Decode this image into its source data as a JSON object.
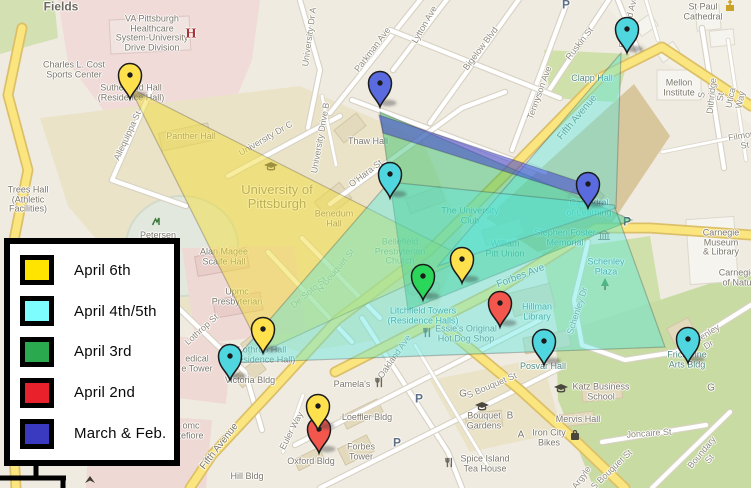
{
  "legend": {
    "items": [
      {
        "label": "April 6th",
        "color": "#FFE400"
      },
      {
        "label": "April 4th/5th",
        "color": "#7DFDFD"
      },
      {
        "label": "April 3rd",
        "color": "#2AA94E"
      },
      {
        "label": "April 2nd",
        "color": "#E8212A"
      },
      {
        "label": "March & Feb.",
        "color": "#3A3AC0"
      }
    ]
  },
  "map": {
    "pin_colors": {
      "yellow": "#FFE14E",
      "cyan": "#4FD6DE",
      "green": "#2BD75A",
      "red": "#F2564D",
      "blue": "#5A6BE0"
    },
    "pins": [
      {
        "place": "Sutherland Hall",
        "color": "yellow",
        "x": 130,
        "y": 99
      },
      {
        "place": "Parkman Ave",
        "color": "blue",
        "x": 380,
        "y": 107
      },
      {
        "place": "Bellefield Ave at Fifth Avenue",
        "color": "cyan",
        "x": 627,
        "y": 53
      },
      {
        "place": "The University Club",
        "color": "cyan",
        "x": 390,
        "y": 198
      },
      {
        "place": "Cathedral of Learning",
        "color": "blue",
        "x": 588,
        "y": 208
      },
      {
        "place": "Litchfield Towers",
        "color": "green",
        "x": 423,
        "y": 300
      },
      {
        "place": "William Pitt Union",
        "color": "yellow",
        "x": 462,
        "y": 283
      },
      {
        "place": "Hillman Library",
        "color": "red",
        "x": 500,
        "y": 327
      },
      {
        "place": "Posvar Hall",
        "color": "cyan",
        "x": 544,
        "y": 365
      },
      {
        "place": "Frick Fine Arts Bldg",
        "color": "cyan",
        "x": 688,
        "y": 363
      },
      {
        "place": "Victoria Bldg",
        "color": "cyan",
        "x": 230,
        "y": 380
      },
      {
        "place": "Lothrop Hall",
        "color": "yellow",
        "x": 263,
        "y": 353
      },
      {
        "place": "Euler Way red",
        "color": "red",
        "x": 319,
        "y": 453
      },
      {
        "place": "Euler Way yellow",
        "color": "yellow",
        "x": 318,
        "y": 430
      }
    ],
    "overlays": [
      {
        "name": "april-6th",
        "color": "#F2DC3C",
        "opacity": 0.5,
        "points": "130,88 466,258 262,352"
      },
      {
        "name": "april-3rd",
        "color": "#2FBF6B",
        "opacity": 0.45,
        "points": "380,112 632,220 408,310"
      },
      {
        "name": "april-4th-5th-a",
        "color": "#55E6E0",
        "opacity": 0.42,
        "points": "621,53 438,266 616,208"
      },
      {
        "name": "april-4th-5th-b",
        "color": "#55E6E0",
        "opacity": 0.42,
        "points": "389,182 614,205 665,347 232,363"
      },
      {
        "name": "march-feb",
        "color": "#4040CF",
        "opacity": 0.55,
        "points": "379,115 586,184 589,198 383,133"
      }
    ],
    "roads": [
      {
        "name": "parkman-ave",
        "type": "street",
        "d": "M330 113L428 -10"
      },
      {
        "name": "lytton-ave",
        "type": "street",
        "d": "M393 70L458 -15"
      },
      {
        "name": "bigelow-blvd",
        "type": "street",
        "d": "M430 123L527 -12"
      },
      {
        "name": "tennyson-ave",
        "type": "street",
        "d": "M512 150L566 5"
      },
      {
        "name": "ruskin-st",
        "type": "street",
        "d": "M548 92L612 -5"
      },
      {
        "name": "grid-cross-1",
        "type": "street",
        "d": "M352 100L545 172"
      },
      {
        "name": "grid-cross-2",
        "type": "street",
        "d": "M390 30L560 98"
      },
      {
        "name": "ohara-st",
        "type": "street",
        "d": "M330 204L462 108L505 92"
      },
      {
        "name": "bellefield-ave",
        "type": "street",
        "d": "M618 0L641 58"
      },
      {
        "name": "s-dithridge-st",
        "type": "street",
        "d": "M702 28L724 168"
      },
      {
        "name": "utica-way",
        "type": "thin",
        "d": "M728 40L746 160"
      },
      {
        "name": "filmore-st",
        "type": "thin",
        "d": "M662 152L751 134"
      },
      {
        "name": "craig-st",
        "type": "thin",
        "d": "M646 0L658 40"
      },
      {
        "name": "university-dr-a",
        "type": "street",
        "d": "M300 0L320 70L308 128"
      },
      {
        "name": "university-dr-c",
        "type": "street",
        "d": "M228 176L340 116"
      },
      {
        "name": "university-drive-b",
        "type": "thin",
        "d": "M322 96L336 165"
      },
      {
        "name": "allequippa-st",
        "type": "street",
        "d": "M152 88L112 180L186 206"
      },
      {
        "name": "n-bouquet-st",
        "type": "street",
        "d": "M302 238L380 318"
      },
      {
        "name": "de-soto-st",
        "type": "street",
        "d": "M268 252L352 342"
      },
      {
        "name": "lothrop-st",
        "type": "street",
        "d": "M168 298L245 372L262 430"
      },
      {
        "name": "oakland-ave",
        "type": "street",
        "d": "M362 318L448 452L462 488"
      },
      {
        "name": "sennott-st",
        "type": "street",
        "d": "M295 445L540 320"
      },
      {
        "name": "lower-cross",
        "type": "street",
        "d": "M320 488L560 368"
      },
      {
        "name": "atwood-st",
        "type": "thin",
        "d": "M415 345L490 470"
      },
      {
        "name": "euler-way",
        "type": "thin",
        "d": "M303 395L283 452"
      },
      {
        "name": "joncaire-st",
        "type": "street",
        "d": "M602 442L706 425"
      },
      {
        "name": "boundary-st",
        "type": "street",
        "d": "M652 488L730 412"
      },
      {
        "name": "schenley-dr",
        "type": "street",
        "d": "M588 242L574 300L582 345L625 360L676 352L751 305"
      },
      {
        "name": "left-loop-road",
        "type": "major",
        "d": "M22 28L8 95L28 170L12 250L26 330L12 420L16 488"
      },
      {
        "name": "s-bouquet-st",
        "type": "major",
        "d": "M438 322L520 390L575 440L625 488"
      },
      {
        "name": "forbes-ave",
        "type": "major",
        "d": "M335 372L500 288L596 228L650 228L751 235"
      },
      {
        "name": "fifth-avenue",
        "type": "major",
        "d": "M751 106L662 47L600 78L505 175L430 250L337 320L268 395L212 455L190 488"
      }
    ],
    "labels": [
      {
        "t": "Allequippa St",
        "x": 128,
        "y": 136,
        "r": -65,
        "c": "st"
      },
      {
        "t": "University Dr A",
        "x": 310,
        "y": 37,
        "r": -82,
        "c": "st"
      },
      {
        "t": "University Dr C",
        "x": 266,
        "y": 139,
        "r": -30,
        "c": "st"
      },
      {
        "t": "University Drive B",
        "x": 321,
        "y": 138,
        "r": -80,
        "c": "st"
      },
      {
        "t": "Parkman Ave",
        "x": 373,
        "y": 50,
        "r": -53,
        "c": "st"
      },
      {
        "t": "Lytton Ave",
        "x": 425,
        "y": 25,
        "r": -60,
        "c": "st"
      },
      {
        "t": "Bigelow Blvd",
        "x": 481,
        "y": 49,
        "r": -53,
        "c": "st"
      },
      {
        "t": "Tennyson Ave",
        "x": 540,
        "y": 93,
        "r": -70,
        "c": "st"
      },
      {
        "t": "Ruskin St",
        "x": 580,
        "y": 44,
        "r": -52,
        "c": "st"
      },
      {
        "t": "Bellefield Ave",
        "x": 629,
        "y": 22,
        "r": -76,
        "c": "st"
      },
      {
        "t": "O'Hara St",
        "x": 366,
        "y": 174,
        "r": -37,
        "c": "st"
      },
      {
        "t": "S Dithridge St",
        "x": 712,
        "y": 96,
        "r": -84,
        "c": "st"
      },
      {
        "t": "Utica Way",
        "x": 736,
        "y": 99,
        "r": -78,
        "c": "st"
      },
      {
        "t": "Filmore St",
        "x": 744,
        "y": 141,
        "r": -10,
        "c": "st"
      },
      {
        "t": "N Bouquet St",
        "x": 336,
        "y": 271,
        "r": -50,
        "c": "st"
      },
      {
        "t": "De Soto St",
        "x": 309,
        "y": 293,
        "r": -40,
        "c": "st"
      },
      {
        "t": "Lothrop St",
        "x": 202,
        "y": 330,
        "r": -42,
        "c": "st"
      },
      {
        "t": "Oakland Ave",
        "x": 395,
        "y": 357,
        "r": -55,
        "c": "st"
      },
      {
        "t": "Euler Way",
        "x": 292,
        "y": 431,
        "r": -63,
        "c": "st"
      },
      {
        "t": "S Bouquet St",
        "x": 492,
        "y": 386,
        "r": -23,
        "c": "st"
      },
      {
        "t": "S Bouquet St",
        "x": 612,
        "y": 470,
        "r": -44,
        "c": "st"
      },
      {
        "t": "Argyle",
        "x": 582,
        "y": 478,
        "r": -55,
        "c": "st"
      },
      {
        "t": "Joncaire St",
        "x": 649,
        "y": 434,
        "r": -4,
        "c": "st"
      },
      {
        "t": "Boundary St",
        "x": 706,
        "y": 456,
        "r": -50,
        "c": "st"
      },
      {
        "t": "Schenley Dr",
        "x": 578,
        "y": 311,
        "r": -72,
        "c": "st"
      },
      {
        "t": "Schenley Dr",
        "x": 706,
        "y": 341,
        "r": -32,
        "c": "st"
      },
      {
        "t": "Fifth Avenue",
        "x": 578,
        "y": 118,
        "r": -50,
        "c": "rd"
      },
      {
        "t": "Fifth Avenue",
        "x": 220,
        "y": 447,
        "r": -52,
        "c": "rd"
      },
      {
        "t": "Forbes Ave",
        "x": 521,
        "y": 277,
        "r": -21,
        "c": "rd"
      },
      {
        "t": "Fields",
        "x": 61,
        "y": 7,
        "r": 0,
        "c": "big"
      },
      {
        "t": "VA Pittsburgh\nHealthcare\nSystem-University\nDrive Division",
        "x": 152,
        "y": 34,
        "r": 0,
        "c": "hall"
      },
      {
        "t": "Charles L. Cost\nSports Center",
        "x": 74,
        "y": 70,
        "r": 0,
        "c": "hall"
      },
      {
        "t": "Sutherland Hall\n(Residence Hall)",
        "x": 131,
        "y": 93,
        "r": 0,
        "c": "hall"
      },
      {
        "t": "Panther Hall",
        "x": 191,
        "y": 137,
        "r": 0,
        "c": "hall"
      },
      {
        "t": "Trees Hall\n(Athletic\nFacilities)",
        "x": 28,
        "y": 200,
        "r": 0,
        "c": "hall"
      },
      {
        "t": "Petersen",
        "x": 158,
        "y": 236,
        "r": 0,
        "c": "hall"
      },
      {
        "t": "Alan Magee\nScaife Hall",
        "x": 224,
        "y": 257,
        "r": 0,
        "c": "hall"
      },
      {
        "t": "Upmc\nPresbyterian",
        "x": 237,
        "y": 297,
        "r": 0,
        "c": "hall"
      },
      {
        "t": "University of\nPittsburgh",
        "x": 277,
        "y": 197,
        "r": 0,
        "c": "city"
      },
      {
        "t": "Benedum\nHall",
        "x": 334,
        "y": 219,
        "r": 0,
        "c": "hall"
      },
      {
        "t": "Thaw Hall",
        "x": 368,
        "y": 142,
        "r": 0,
        "c": "hall"
      },
      {
        "t": "The University\nClub",
        "x": 470,
        "y": 216,
        "r": 0,
        "c": "poi"
      },
      {
        "t": "Bellefield\nPresbyterian\nChurch",
        "x": 400,
        "y": 252,
        "r": 0,
        "c": "poi"
      },
      {
        "t": "William\nPitt Union",
        "x": 505,
        "y": 249,
        "r": 0,
        "c": "poi"
      },
      {
        "t": "Litchfield Towers\n(Residence Halls)",
        "x": 423,
        "y": 316,
        "r": 0,
        "c": "poi"
      },
      {
        "t": "Stephen Foster\nMemorial",
        "x": 565,
        "y": 238,
        "r": 0,
        "c": "poi"
      },
      {
        "t": "Cathedral\nof Learning",
        "x": 589,
        "y": 208,
        "r": 0,
        "c": "poi"
      },
      {
        "t": "Schenley\nPlaza",
        "x": 606,
        "y": 267,
        "r": 0,
        "c": "poi"
      },
      {
        "t": "Hillman\nLibrary",
        "x": 537,
        "y": 312,
        "r": 0,
        "c": "poi"
      },
      {
        "t": "Posvar Hall",
        "x": 543,
        "y": 367,
        "r": 0,
        "c": "poi"
      },
      {
        "t": "Frick Fine\nArts Bldg",
        "x": 687,
        "y": 360,
        "r": 0,
        "c": "poi"
      },
      {
        "t": "Clapp Hall",
        "x": 592,
        "y": 79,
        "r": 0,
        "c": "poi"
      },
      {
        "t": "Katz Business\nSchool",
        "x": 601,
        "y": 392,
        "r": 0,
        "c": "hall"
      },
      {
        "t": "Mervis Hall",
        "x": 578,
        "y": 420,
        "r": 0,
        "c": "hall"
      },
      {
        "t": "Iron City\nBikes",
        "x": 549,
        "y": 438,
        "r": 0,
        "c": "hall"
      },
      {
        "t": "Bouquet\nGardens",
        "x": 484,
        "y": 421,
        "r": 0,
        "c": "hall"
      },
      {
        "t": "Spice Island\nTea House",
        "x": 485,
        "y": 464,
        "r": 0,
        "c": "hall"
      },
      {
        "t": "Essie's Original\nHot Dog Shop",
        "x": 466,
        "y": 334,
        "r": 0,
        "c": "hall"
      },
      {
        "t": "Pamela's",
        "x": 352,
        "y": 385,
        "r": 0,
        "c": "hall"
      },
      {
        "t": "Loeffler Bldg",
        "x": 367,
        "y": 418,
        "r": 0,
        "c": "hall"
      },
      {
        "t": "Forbes\nTower",
        "x": 361,
        "y": 452,
        "r": 0,
        "c": "hall"
      },
      {
        "t": "Oxford Bldg",
        "x": 311,
        "y": 462,
        "r": 0,
        "c": "hall"
      },
      {
        "t": "Victoria Bldg",
        "x": 250,
        "y": 381,
        "r": 0,
        "c": "hall"
      },
      {
        "t": "Lothrop Hall\n(Residence Hall)",
        "x": 262,
        "y": 355,
        "r": 0,
        "c": "hall"
      },
      {
        "t": "edical\ne Tower",
        "x": 197,
        "y": 364,
        "r": 0,
        "c": "hall"
      },
      {
        "t": "omc\ntefiore",
        "x": 191,
        "y": 431,
        "r": 0,
        "c": "hall"
      },
      {
        "t": "Hill Bldg",
        "x": 247,
        "y": 477,
        "r": 0,
        "c": "hall"
      },
      {
        "t": "Mellon\nInstitute",
        "x": 679,
        "y": 88,
        "r": 0,
        "c": "hall"
      },
      {
        "t": "St Paul\nCathedral",
        "x": 703,
        "y": 12,
        "r": 0,
        "c": "hall"
      },
      {
        "t": "Carnegie\nMuseum\n& Library",
        "x": 721,
        "y": 243,
        "r": 0,
        "c": "hall"
      },
      {
        "t": "Carnegie\nof Natu",
        "x": 737,
        "y": 278,
        "r": 0,
        "c": "hall"
      },
      {
        "t": "P",
        "x": 627,
        "y": 222,
        "r": 0,
        "c": "P"
      },
      {
        "t": "P",
        "x": 566,
        "y": 5,
        "r": 0,
        "c": "P"
      },
      {
        "t": "P",
        "x": 419,
        "y": 399,
        "r": 0,
        "c": "P"
      },
      {
        "t": "P",
        "x": 397,
        "y": 443,
        "r": 0,
        "c": "P"
      },
      {
        "t": "G",
        "x": 463,
        "y": 395,
        "r": 0,
        "c": "ltr"
      },
      {
        "t": "B",
        "x": 510,
        "y": 417,
        "r": 0,
        "c": "ltr"
      },
      {
        "t": "A",
        "x": 521,
        "y": 436,
        "r": 0,
        "c": "ltr"
      },
      {
        "t": "G",
        "x": 711,
        "y": 389,
        "r": 0,
        "c": "ltr"
      },
      {
        "t": "H",
        "x": 191,
        "y": 34,
        "r": 0,
        "c": "H"
      }
    ],
    "icons": [
      {
        "type": "fork-knife",
        "x": 380,
        "y": 384
      },
      {
        "type": "fork-knife",
        "x": 428,
        "y": 334
      },
      {
        "type": "fork-knife",
        "x": 450,
        "y": 464
      },
      {
        "type": "shopping-bag",
        "x": 575,
        "y": 437
      },
      {
        "type": "grad-cap",
        "x": 561,
        "y": 390
      },
      {
        "type": "grad-cap",
        "x": 482,
        "y": 408
      },
      {
        "type": "grad-cap",
        "x": 271,
        "y": 168
      },
      {
        "type": "tree",
        "x": 605,
        "y": 287
      },
      {
        "type": "church",
        "x": 730,
        "y": 7
      },
      {
        "type": "landmark",
        "x": 604,
        "y": 236
      },
      {
        "type": "monument",
        "x": 156,
        "y": 222
      },
      {
        "type": "poi-dark",
        "x": 90,
        "y": 481
      }
    ]
  }
}
